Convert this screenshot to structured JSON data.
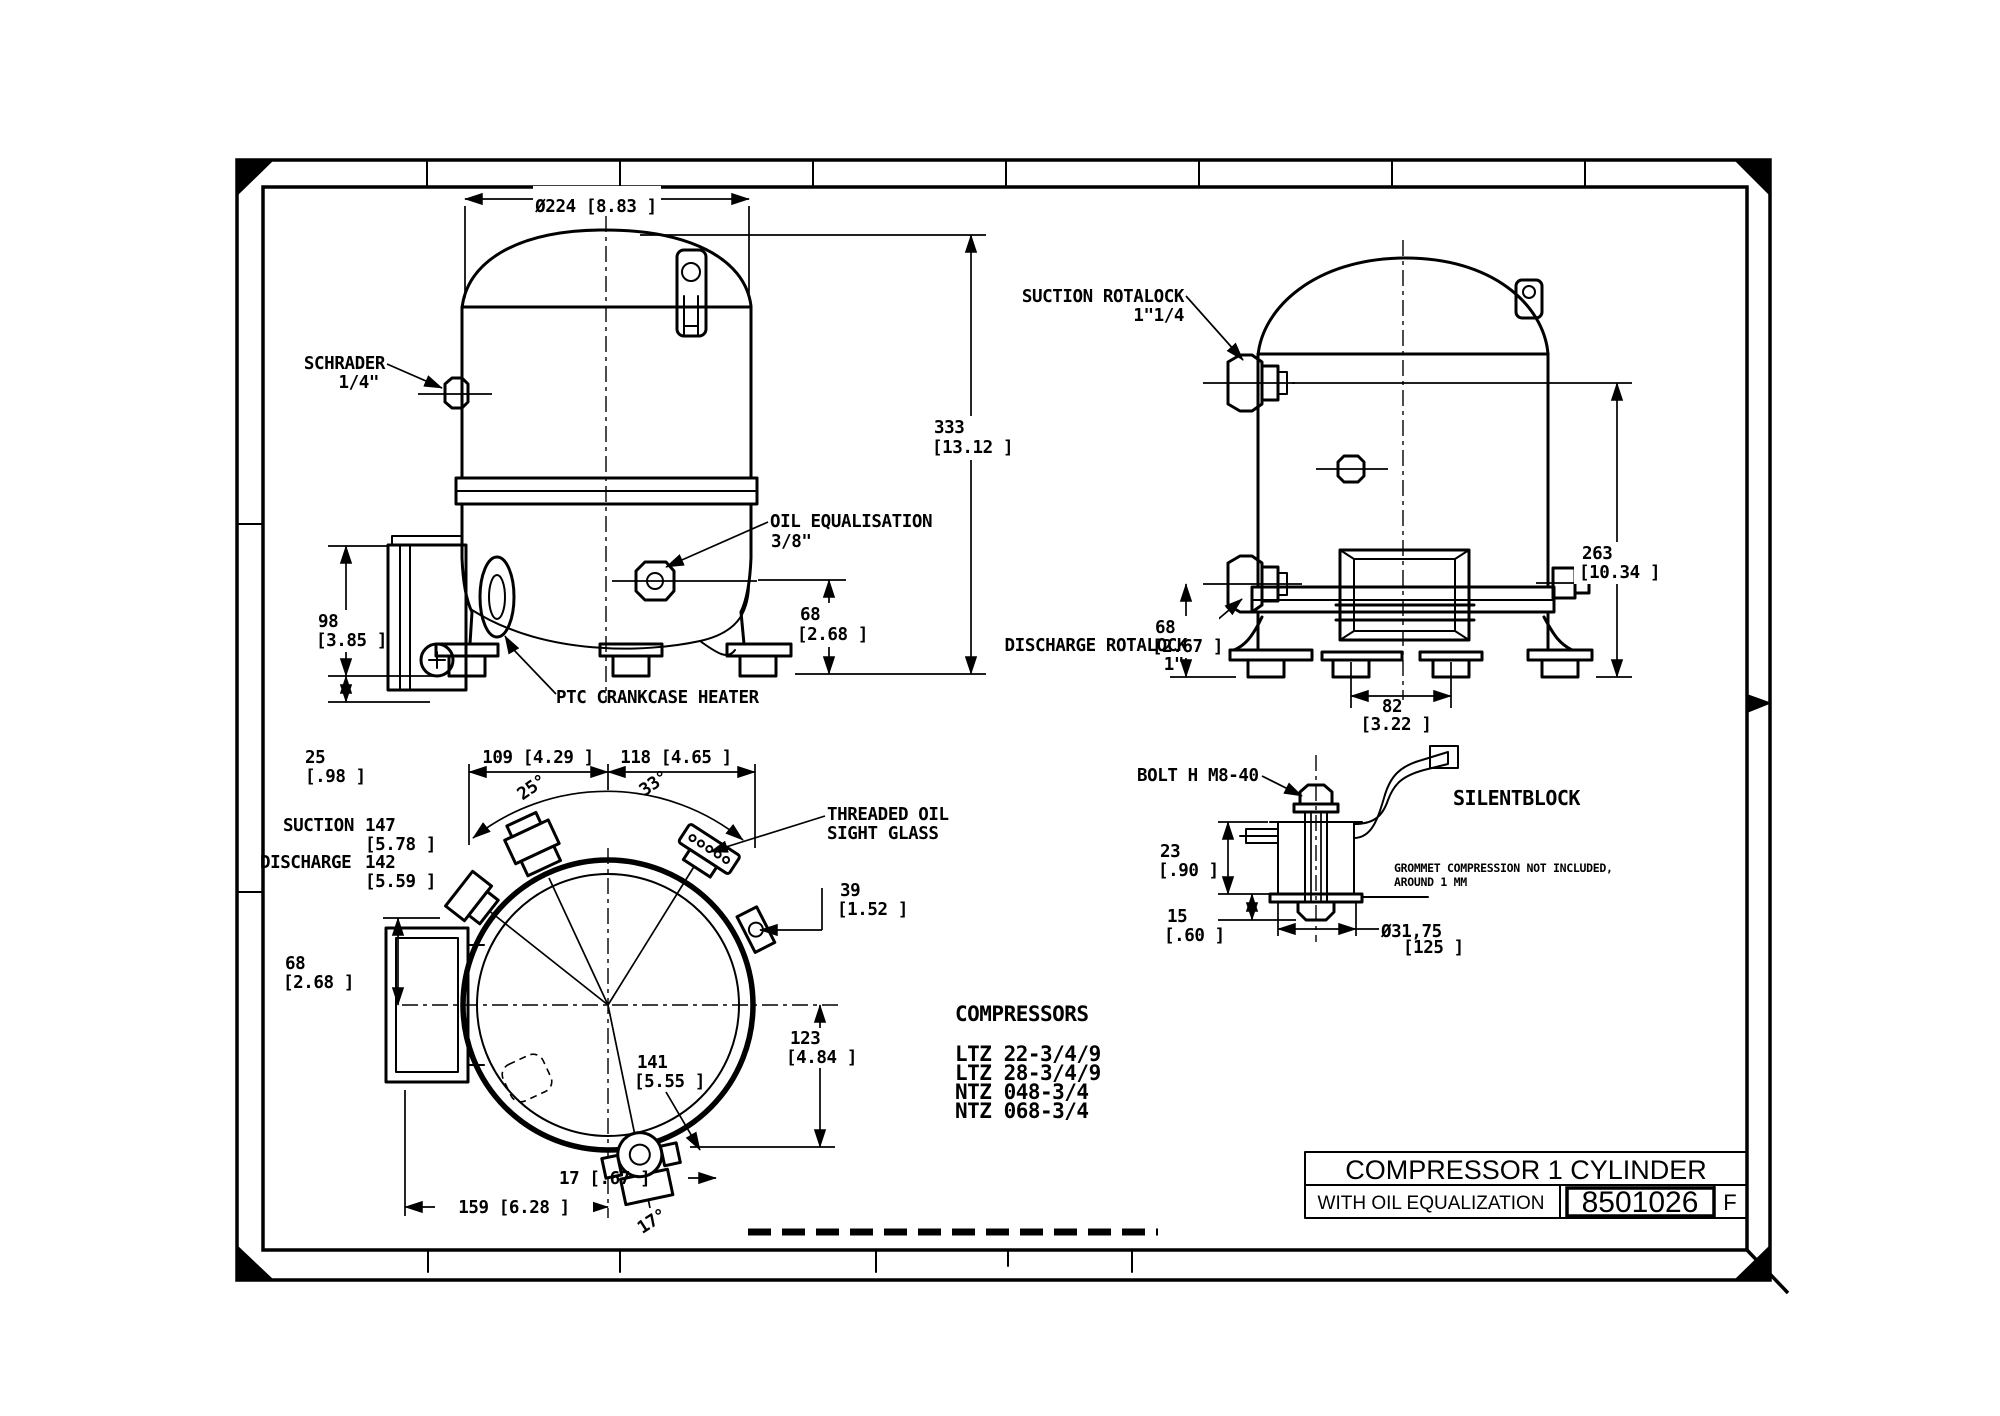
{
  "colors": {
    "ink": "#000000",
    "paper": "#ffffff"
  },
  "front": {
    "dia": "Ø224 [8.83 ]",
    "schrader_1": "SCHRADER",
    "schrader_2": "1/4\"",
    "oil_1": "OIL EQUALISATION",
    "oil_2": "3/8\"",
    "ptc": "PTC CRANKCASE HEATER",
    "h333": "333",
    "h333_in": "[13.12  ]",
    "h68": "68",
    "h68_in": "[2.68 ]",
    "h98": "98",
    "h98_in": "[3.85 ]",
    "h25": "25",
    "h25_in": "[.98 ]"
  },
  "side": {
    "suction_1": "SUCTION ROTALOCK",
    "suction_2": "1\"1/4",
    "discharge_1": "DISCHARGE ROTALOCK",
    "discharge_2": "1\"",
    "h263": "263",
    "h263_in": "[10.34  ]",
    "h68": "68",
    "h68_in": "[2.67 ]",
    "w82": "82",
    "w82_in": "[3.22 ]"
  },
  "top": {
    "w109": "109  [4.29 ]",
    "w118": "118  [4.65 ]",
    "a25": "25°",
    "a33": "33°",
    "a17": "17°",
    "suction_label": "SUCTION",
    "suction_val": "147",
    "suction_in": "[5.78 ]",
    "discharge_label": "DISCHARGE",
    "discharge_val": "142",
    "discharge_in": "[5.59 ]",
    "h68": "68",
    "h68_in": "[2.68 ]",
    "sight_1": "THREADED OIL",
    "sight_2": "SIGHT GLASS",
    "w39": "39",
    "w39_in": "[1.52 ]",
    "r141": "141",
    "r141_in": "[5.55 ]",
    "h123": "123",
    "h123_in": "[4.84 ]",
    "off17": "17 [.67 ]",
    "w159": "159 [6.28 ]"
  },
  "silentblock": {
    "bolt": "BOLT H M8-40",
    "title": "SILENTBLOCK",
    "note_1": "GROMMET COMPRESSION NOT INCLUDED,",
    "note_2": "AROUND 1 MM",
    "h23": "23",
    "h23_in": "[.90 ]",
    "h15": "15",
    "h15_in": "[.60 ]",
    "dia": "Ø31,75",
    "dia_in": "[125  ]"
  },
  "compressors": {
    "heading": "COMPRESSORS",
    "models": [
      "LTZ 22-3/4/9",
      "LTZ 28-3/4/9",
      "NTZ 048-3/4",
      "NTZ 068-3/4"
    ]
  },
  "title_block": {
    "title": "COMPRESSOR 1 CYLINDER",
    "subtitle": "WITH OIL EQUALIZATION",
    "drawing_number": "8501026",
    "revision": "F"
  }
}
